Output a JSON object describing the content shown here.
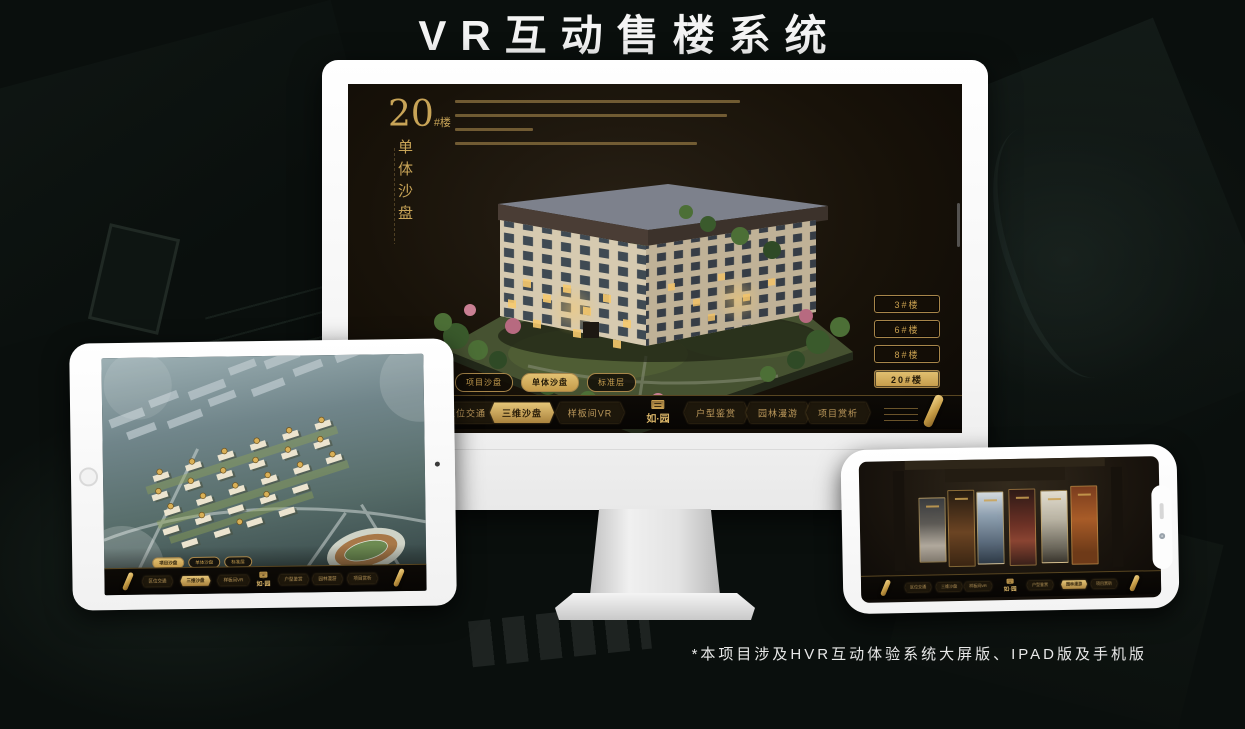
{
  "page": {
    "title": "VR互动售楼系统",
    "footnote": "*本项目涉及HVR互动体验系统大屏版、IPAD版及手机版"
  },
  "app": {
    "logo_text": "如·园",
    "nav_items": [
      "区位交通",
      "三维沙盘",
      "样板间VR",
      "户型鉴赏",
      "园林漫游",
      "项目赏析"
    ]
  },
  "monitor": {
    "panel_title": {
      "number": "20",
      "suffix": "#楼",
      "subtitle_vertical": "单体沙盘"
    },
    "floor_buttons": [
      {
        "label": "3#楼",
        "active": false
      },
      {
        "label": "6#楼",
        "active": false
      },
      {
        "label": "8#楼",
        "active": false
      },
      {
        "label": "20#楼",
        "active": true
      }
    ],
    "sub_tabs": [
      {
        "label": "项目沙盘",
        "active": false
      },
      {
        "label": "单体沙盘",
        "active": true
      },
      {
        "label": "标准层",
        "active": false
      }
    ],
    "active_nav_item": "三维沙盘"
  },
  "tablet": {
    "sub_tabs": [
      {
        "label": "项目沙盘",
        "active": true
      },
      {
        "label": "单体沙盘",
        "active": false
      },
      {
        "label": "标准层",
        "active": false
      }
    ],
    "active_nav_item": "三维沙盘"
  },
  "phone": {
    "active_nav_item": "园林漫游"
  },
  "colors": {
    "gold": "#c9a050",
    "gold_active": "#d9b25c",
    "screen_dark": "#17120c"
  }
}
